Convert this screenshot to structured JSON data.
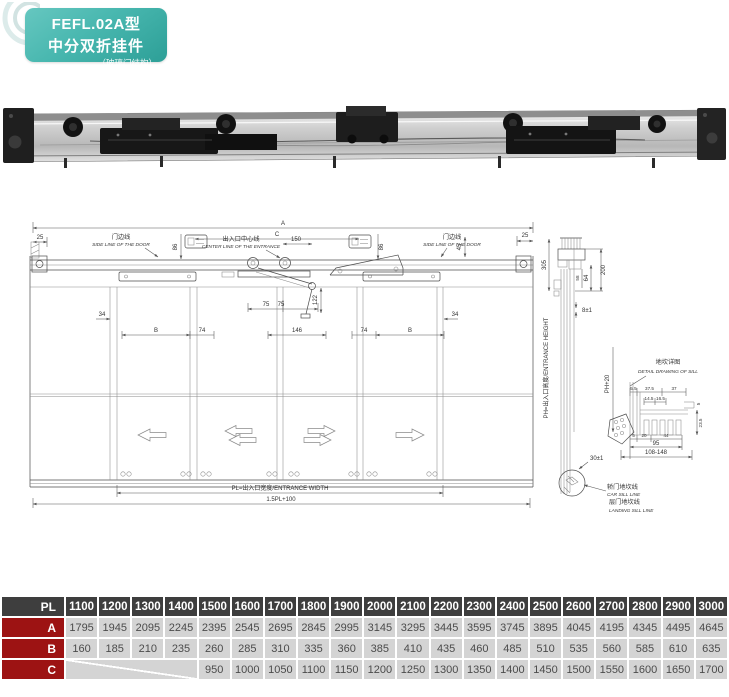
{
  "header": {
    "model": "FEFL.02A型",
    "name": "中分双折挂件",
    "sub": "（玻璃门结构）"
  },
  "drawing": {
    "dims": {
      "a": "A",
      "c": "C",
      "n25": "25",
      "n150": "150",
      "n86": "86",
      "n45": "45",
      "n34": "34",
      "b": "B",
      "n74": "74",
      "n75": "75",
      "n122": "122",
      "n146": "146",
      "pl": "PL=出入口宽度/ENTRANCE WIDTH",
      "pl15": "1.5PL+100",
      "ph": "PH=出入口高度/ENTRANCE HEIGHT",
      "ph20": "PH+20",
      "n305": "305",
      "n200": "200",
      "n64": "64",
      "n58": "58",
      "n8": "8±1",
      "n30": "30±1"
    },
    "labels": {
      "door_line_cn": "门边线",
      "door_line_en": "SIDE LINE OF THE DOOR",
      "center_line_cn": "出入口中心线",
      "center_line_en": "CENTER LINE OF THE ENTRANCE",
      "car_sill_cn": "轿门地坎线",
      "car_sill_en": "CAR SILL LINE",
      "landing_sill_cn": "层门地坎线",
      "landing_sill_en": "LANDING SILL LINE"
    },
    "sill": {
      "title_cn": "地坎详图",
      "title_en": "DETAIL DRAWING OF SILL",
      "n55": "5.5",
      "n375": "37.5",
      "n37": "37",
      "n145": "14.5",
      "n165": "16.5",
      "n235": "23.5",
      "n5a": "5",
      "n5b": "5",
      "n20": "20",
      "n44": "44",
      "n95": "95",
      "range": "108-148"
    }
  },
  "table": {
    "header_label": "PL",
    "header_values": [
      "1100",
      "1200",
      "1300",
      "1400",
      "1500",
      "1600",
      "1700",
      "1800",
      "1900",
      "2000",
      "2100",
      "2200",
      "2300",
      "2400",
      "2500",
      "2600",
      "2700",
      "2800",
      "2900",
      "3000"
    ],
    "rows": [
      {
        "label": "A",
        "values": [
          "1795",
          "1945",
          "2095",
          "2245",
          "2395",
          "2545",
          "2695",
          "2845",
          "2995",
          "3145",
          "3295",
          "3445",
          "3595",
          "3745",
          "3895",
          "4045",
          "4195",
          "4345",
          "4495",
          "4645"
        ]
      },
      {
        "label": "B",
        "values": [
          "160",
          "185",
          "210",
          "235",
          "260",
          "285",
          "310",
          "335",
          "360",
          "385",
          "410",
          "435",
          "460",
          "485",
          "510",
          "535",
          "560",
          "585",
          "610",
          "635"
        ]
      },
      {
        "label": "C",
        "values": [
          "",
          "",
          "",
          "",
          "950",
          "1000",
          "1050",
          "1100",
          "1150",
          "1200",
          "1250",
          "1300",
          "1350",
          "1400",
          "1450",
          "1500",
          "1550",
          "1600",
          "1650",
          "1700"
        ]
      }
    ]
  },
  "colors": {
    "accent_teal": "#48b7af",
    "table_header_bg": "#3e3e3e",
    "table_row_label_bg": "#9d1313",
    "table_cell_bg": "#d4d4d4",
    "drawing_line": "#4d4d4d"
  }
}
